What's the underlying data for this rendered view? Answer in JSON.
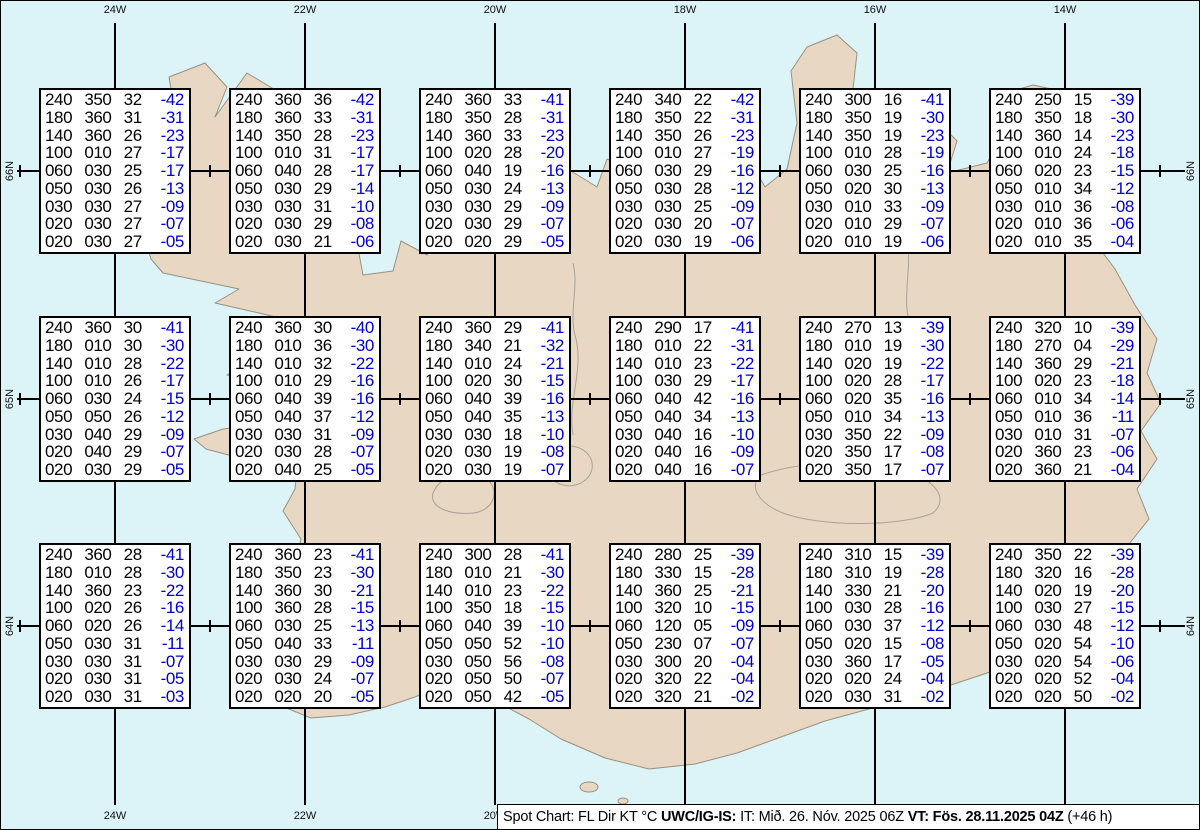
{
  "map": {
    "region_name": "Iceland",
    "ocean_color": "#dcf3f8",
    "land_color": "#e8d7c3",
    "coast_color": "#99917f",
    "grid": {
      "meridians": [
        {
          "label": "24W",
          "x": 114
        },
        {
          "label": "22W",
          "x": 304
        },
        {
          "label": "20W",
          "x": 494
        },
        {
          "label": "18W",
          "x": 684
        },
        {
          "label": "16W",
          "x": 874
        },
        {
          "label": "14W",
          "x": 1064
        }
      ],
      "parallels": [
        {
          "label": "66N",
          "y": 170
        },
        {
          "label": "65N",
          "y": 398
        },
        {
          "label": "64N",
          "y": 625
        }
      ]
    }
  },
  "colors": {
    "temp_color": "#0000cc",
    "text_color": "#000000"
  },
  "stations": [
    {
      "row": 0,
      "col": 0,
      "rows": [
        [
          "240",
          "350",
          "32",
          "-42"
        ],
        [
          "180",
          "360",
          "31",
          "-31"
        ],
        [
          "140",
          "360",
          "26",
          "-23"
        ],
        [
          "100",
          "010",
          "27",
          "-17"
        ],
        [
          "060",
          "030",
          "25",
          "-17"
        ],
        [
          "050",
          "030",
          "26",
          "-13"
        ],
        [
          "030",
          "030",
          "27",
          "-09"
        ],
        [
          "020",
          "030",
          "27",
          "-07"
        ],
        [
          "020",
          "030",
          "27",
          "-05"
        ]
      ]
    },
    {
      "row": 0,
      "col": 1,
      "rows": [
        [
          "240",
          "360",
          "36",
          "-42"
        ],
        [
          "180",
          "360",
          "33",
          "-31"
        ],
        [
          "140",
          "350",
          "28",
          "-23"
        ],
        [
          "100",
          "010",
          "31",
          "-17"
        ],
        [
          "060",
          "040",
          "28",
          "-17"
        ],
        [
          "050",
          "030",
          "29",
          "-14"
        ],
        [
          "030",
          "030",
          "31",
          "-10"
        ],
        [
          "020",
          "030",
          "29",
          "-08"
        ],
        [
          "020",
          "030",
          "21",
          "-06"
        ]
      ]
    },
    {
      "row": 0,
      "col": 2,
      "rows": [
        [
          "240",
          "360",
          "33",
          "-41"
        ],
        [
          "180",
          "350",
          "28",
          "-31"
        ],
        [
          "140",
          "360",
          "33",
          "-23"
        ],
        [
          "100",
          "020",
          "28",
          "-20"
        ],
        [
          "060",
          "040",
          "19",
          "-16"
        ],
        [
          "050",
          "030",
          "24",
          "-13"
        ],
        [
          "030",
          "030",
          "29",
          "-09"
        ],
        [
          "020",
          "030",
          "29",
          "-07"
        ],
        [
          "020",
          "020",
          "29",
          "-05"
        ]
      ]
    },
    {
      "row": 0,
      "col": 3,
      "rows": [
        [
          "240",
          "340",
          "22",
          "-42"
        ],
        [
          "180",
          "350",
          "22",
          "-31"
        ],
        [
          "140",
          "350",
          "26",
          "-23"
        ],
        [
          "100",
          "010",
          "27",
          "-19"
        ],
        [
          "060",
          "030",
          "29",
          "-16"
        ],
        [
          "050",
          "030",
          "28",
          "-12"
        ],
        [
          "030",
          "030",
          "25",
          "-09"
        ],
        [
          "020",
          "030",
          "20",
          "-07"
        ],
        [
          "020",
          "030",
          "19",
          "-06"
        ]
      ]
    },
    {
      "row": 0,
      "col": 4,
      "rows": [
        [
          "240",
          "300",
          "16",
          "-41"
        ],
        [
          "180",
          "350",
          "19",
          "-30"
        ],
        [
          "140",
          "350",
          "19",
          "-23"
        ],
        [
          "100",
          "010",
          "28",
          "-19"
        ],
        [
          "060",
          "030",
          "25",
          "-16"
        ],
        [
          "050",
          "020",
          "30",
          "-13"
        ],
        [
          "030",
          "010",
          "33",
          "-09"
        ],
        [
          "020",
          "010",
          "29",
          "-07"
        ],
        [
          "020",
          "010",
          "19",
          "-06"
        ]
      ]
    },
    {
      "row": 0,
      "col": 5,
      "rows": [
        [
          "240",
          "250",
          "15",
          "-39"
        ],
        [
          "180",
          "350",
          "18",
          "-30"
        ],
        [
          "140",
          "360",
          "14",
          "-23"
        ],
        [
          "100",
          "010",
          "24",
          "-18"
        ],
        [
          "060",
          "020",
          "23",
          "-15"
        ],
        [
          "050",
          "010",
          "34",
          "-12"
        ],
        [
          "030",
          "010",
          "36",
          "-08"
        ],
        [
          "020",
          "010",
          "36",
          "-06"
        ],
        [
          "020",
          "010",
          "35",
          "-04"
        ]
      ]
    },
    {
      "row": 1,
      "col": 0,
      "rows": [
        [
          "240",
          "360",
          "30",
          "-41"
        ],
        [
          "180",
          "010",
          "30",
          "-30"
        ],
        [
          "140",
          "010",
          "28",
          "-22"
        ],
        [
          "100",
          "010",
          "26",
          "-17"
        ],
        [
          "060",
          "030",
          "24",
          "-15"
        ],
        [
          "050",
          "050",
          "26",
          "-12"
        ],
        [
          "030",
          "040",
          "29",
          "-09"
        ],
        [
          "020",
          "040",
          "29",
          "-07"
        ],
        [
          "020",
          "030",
          "29",
          "-05"
        ]
      ]
    },
    {
      "row": 1,
      "col": 1,
      "rows": [
        [
          "240",
          "360",
          "30",
          "-40"
        ],
        [
          "180",
          "010",
          "36",
          "-30"
        ],
        [
          "140",
          "010",
          "32",
          "-22"
        ],
        [
          "100",
          "010",
          "29",
          "-16"
        ],
        [
          "060",
          "040",
          "39",
          "-16"
        ],
        [
          "050",
          "040",
          "37",
          "-12"
        ],
        [
          "030",
          "030",
          "31",
          "-09"
        ],
        [
          "020",
          "030",
          "28",
          "-07"
        ],
        [
          "020",
          "040",
          "25",
          "-05"
        ]
      ]
    },
    {
      "row": 1,
      "col": 2,
      "rows": [
        [
          "240",
          "360",
          "29",
          "-41"
        ],
        [
          "180",
          "340",
          "21",
          "-32"
        ],
        [
          "140",
          "010",
          "24",
          "-21"
        ],
        [
          "100",
          "020",
          "30",
          "-15"
        ],
        [
          "060",
          "040",
          "39",
          "-16"
        ],
        [
          "050",
          "040",
          "35",
          "-13"
        ],
        [
          "030",
          "030",
          "18",
          "-10"
        ],
        [
          "020",
          "030",
          "19",
          "-08"
        ],
        [
          "020",
          "030",
          "19",
          "-07"
        ]
      ]
    },
    {
      "row": 1,
      "col": 3,
      "rows": [
        [
          "240",
          "290",
          "17",
          "-41"
        ],
        [
          "180",
          "010",
          "22",
          "-31"
        ],
        [
          "140",
          "010",
          "23",
          "-22"
        ],
        [
          "100",
          "030",
          "29",
          "-17"
        ],
        [
          "060",
          "040",
          "42",
          "-16"
        ],
        [
          "050",
          "040",
          "34",
          "-13"
        ],
        [
          "030",
          "040",
          "16",
          "-10"
        ],
        [
          "020",
          "040",
          "16",
          "-09"
        ],
        [
          "020",
          "040",
          "16",
          "-07"
        ]
      ]
    },
    {
      "row": 1,
      "col": 4,
      "rows": [
        [
          "240",
          "270",
          "13",
          "-39"
        ],
        [
          "180",
          "010",
          "19",
          "-30"
        ],
        [
          "140",
          "020",
          "19",
          "-22"
        ],
        [
          "100",
          "020",
          "28",
          "-17"
        ],
        [
          "060",
          "020",
          "35",
          "-16"
        ],
        [
          "050",
          "010",
          "34",
          "-13"
        ],
        [
          "030",
          "350",
          "22",
          "-09"
        ],
        [
          "020",
          "350",
          "17",
          "-08"
        ],
        [
          "020",
          "350",
          "17",
          "-07"
        ]
      ]
    },
    {
      "row": 1,
      "col": 5,
      "rows": [
        [
          "240",
          "320",
          "10",
          "-39"
        ],
        [
          "180",
          "270",
          "04",
          "-29"
        ],
        [
          "140",
          "360",
          "29",
          "-21"
        ],
        [
          "100",
          "020",
          "23",
          "-18"
        ],
        [
          "060",
          "010",
          "34",
          "-14"
        ],
        [
          "050",
          "010",
          "36",
          "-11"
        ],
        [
          "030",
          "010",
          "31",
          "-07"
        ],
        [
          "020",
          "360",
          "23",
          "-06"
        ],
        [
          "020",
          "360",
          "21",
          "-04"
        ]
      ]
    },
    {
      "row": 2,
      "col": 0,
      "rows": [
        [
          "240",
          "360",
          "28",
          "-41"
        ],
        [
          "180",
          "010",
          "28",
          "-30"
        ],
        [
          "140",
          "360",
          "23",
          "-22"
        ],
        [
          "100",
          "020",
          "26",
          "-16"
        ],
        [
          "060",
          "020",
          "26",
          "-14"
        ],
        [
          "050",
          "030",
          "31",
          "-11"
        ],
        [
          "030",
          "030",
          "31",
          "-07"
        ],
        [
          "020",
          "030",
          "31",
          "-05"
        ],
        [
          "020",
          "030",
          "31",
          "-03"
        ]
      ]
    },
    {
      "row": 2,
      "col": 1,
      "rows": [
        [
          "240",
          "360",
          "23",
          "-41"
        ],
        [
          "180",
          "350",
          "23",
          "-30"
        ],
        [
          "140",
          "360",
          "30",
          "-21"
        ],
        [
          "100",
          "360",
          "28",
          "-15"
        ],
        [
          "060",
          "030",
          "25",
          "-13"
        ],
        [
          "050",
          "040",
          "33",
          "-11"
        ],
        [
          "030",
          "030",
          "29",
          "-09"
        ],
        [
          "020",
          "030",
          "24",
          "-07"
        ],
        [
          "020",
          "020",
          "20",
          "-05"
        ]
      ]
    },
    {
      "row": 2,
      "col": 2,
      "rows": [
        [
          "240",
          "300",
          "28",
          "-41"
        ],
        [
          "180",
          "010",
          "21",
          "-30"
        ],
        [
          "140",
          "010",
          "23",
          "-22"
        ],
        [
          "100",
          "350",
          "18",
          "-15"
        ],
        [
          "060",
          "040",
          "39",
          "-10"
        ],
        [
          "050",
          "050",
          "52",
          "-10"
        ],
        [
          "030",
          "050",
          "56",
          "-08"
        ],
        [
          "020",
          "050",
          "50",
          "-07"
        ],
        [
          "020",
          "050",
          "42",
          "-05"
        ]
      ]
    },
    {
      "row": 2,
      "col": 3,
      "rows": [
        [
          "240",
          "280",
          "25",
          "-39"
        ],
        [
          "180",
          "330",
          "15",
          "-28"
        ],
        [
          "140",
          "360",
          "25",
          "-21"
        ],
        [
          "100",
          "320",
          "10",
          "-15"
        ],
        [
          "060",
          "120",
          "05",
          "-09"
        ],
        [
          "050",
          "230",
          "07",
          "-07"
        ],
        [
          "030",
          "300",
          "20",
          "-04"
        ],
        [
          "020",
          "320",
          "22",
          "-04"
        ],
        [
          "020",
          "320",
          "21",
          "-02"
        ]
      ]
    },
    {
      "row": 2,
      "col": 4,
      "rows": [
        [
          "240",
          "310",
          "15",
          "-39"
        ],
        [
          "180",
          "310",
          "19",
          "-28"
        ],
        [
          "140",
          "330",
          "21",
          "-20"
        ],
        [
          "100",
          "030",
          "28",
          "-16"
        ],
        [
          "060",
          "030",
          "37",
          "-12"
        ],
        [
          "050",
          "020",
          "15",
          "-08"
        ],
        [
          "030",
          "360",
          "17",
          "-05"
        ],
        [
          "020",
          "020",
          "24",
          "-04"
        ],
        [
          "020",
          "030",
          "31",
          "-02"
        ]
      ]
    },
    {
      "row": 2,
      "col": 5,
      "rows": [
        [
          "240",
          "350",
          "22",
          "-39"
        ],
        [
          "180",
          "320",
          "16",
          "-28"
        ],
        [
          "140",
          "020",
          "19",
          "-20"
        ],
        [
          "100",
          "030",
          "27",
          "-15"
        ],
        [
          "060",
          "030",
          "48",
          "-12"
        ],
        [
          "050",
          "020",
          "54",
          "-10"
        ],
        [
          "030",
          "020",
          "54",
          "-06"
        ],
        [
          "020",
          "020",
          "52",
          "-04"
        ],
        [
          "020",
          "020",
          "50",
          "-02"
        ]
      ]
    }
  ],
  "footer": {
    "segments": [
      {
        "text": "Spot Chart: FL Dir KT °C ",
        "bold": false
      },
      {
        "text": "UWC/IG-IS:",
        "bold": true
      },
      {
        "text": " IT: Mið. 26. Nóv. 2025 06Z ",
        "bold": false
      },
      {
        "text": "VT: Fös. 28.11.2025 04Z",
        "bold": true
      },
      {
        "text": " (+46 h)",
        "bold": false
      }
    ]
  }
}
